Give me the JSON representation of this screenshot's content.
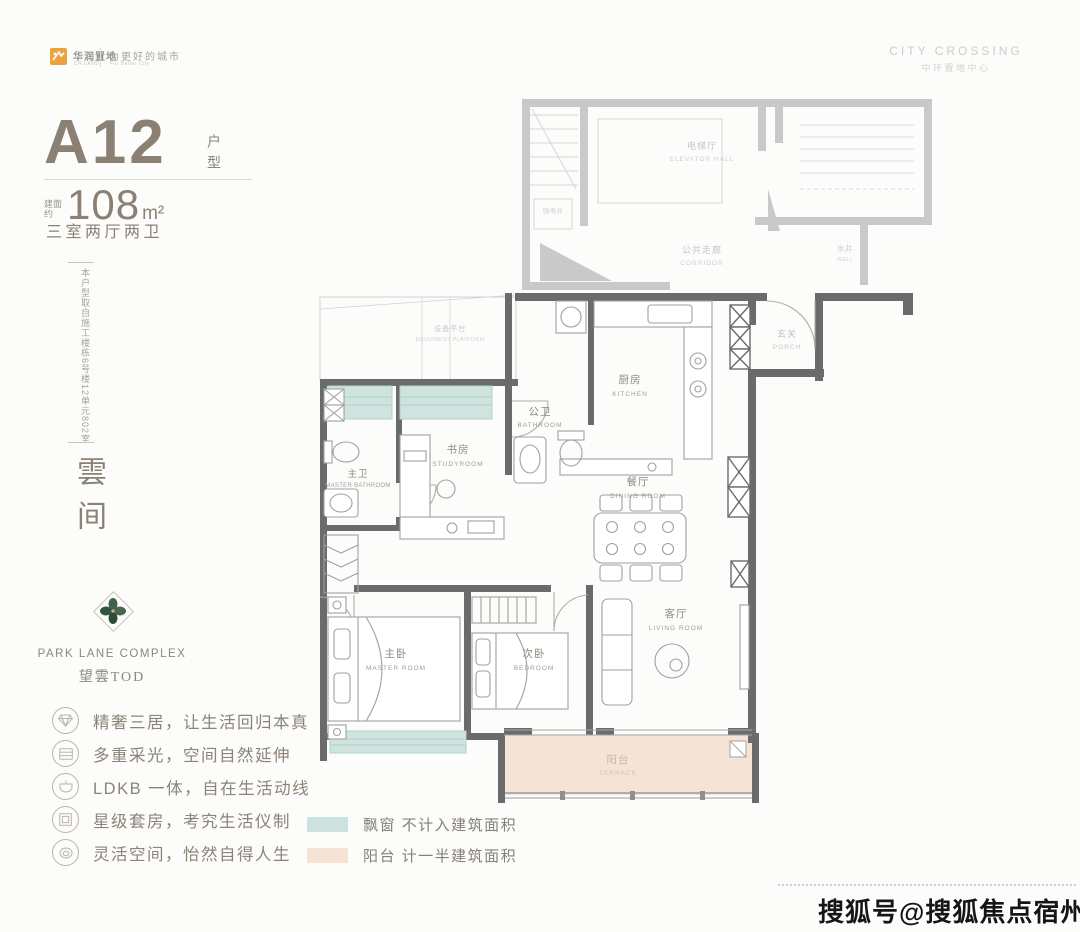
{
  "header": {
    "brand": {
      "name": "华润置地",
      "name_sub": "CR LAND",
      "tagline": "为更好的城市",
      "tagline_sub": "For Better City",
      "accent_color": "#eba33f"
    },
    "project": {
      "en": "CITY CROSSING",
      "cn": "中环置地中心"
    }
  },
  "unit": {
    "code": "A12",
    "code_label": "户型",
    "area_prefix": "建面约",
    "area_value": "108",
    "area_unit": "m²",
    "layout": "三室两厅两卫",
    "source_note": "本户型取自施工楼栋6号楼12单元802室",
    "series_name": "雲间"
  },
  "subbrand": {
    "en": "PARK LANE COMPLEX",
    "cn": "望雲TOD"
  },
  "features": [
    {
      "icon": "gem-icon",
      "text": "精奢三居，让生活回归本真"
    },
    {
      "icon": "daylight-icon",
      "text": "多重采光，空间自然延伸"
    },
    {
      "icon": "ldk-icon",
      "text": "LDKB 一体，自在生活动线"
    },
    {
      "icon": "suite-icon",
      "text": "星级套房，考究生活仪制"
    },
    {
      "icon": "flex-icon",
      "text": "灵活空间，怡然自得人生"
    }
  ],
  "legend": [
    {
      "color": "#cde2de",
      "label": "飘窗 不计入建筑面积"
    },
    {
      "color": "#f6e3d3",
      "label": "阳台 计一半建筑面积"
    }
  ],
  "floorplan": {
    "colors": {
      "wall": "#6b6b6b",
      "faint": "#c9c9c9",
      "bay_window": "#cfe3df",
      "balcony": "#f5e4d6"
    },
    "rooms": {
      "elevator_hall": {
        "cn": "电梯厅",
        "en": "ELEVATOR HALL"
      },
      "corridor": {
        "cn": "公共走廊",
        "en": "CORRIDOR"
      },
      "well": {
        "cn": "水井",
        "en": "WELL"
      },
      "shaft": {
        "cn": "强电井",
        "en": ""
      },
      "equipment": {
        "cn": "设备平台",
        "en": "EQUIPMENT PLATFORM"
      },
      "porch": {
        "cn": "玄关",
        "en": "PORCH"
      },
      "kitchen": {
        "cn": "厨房",
        "en": "KITCHEN"
      },
      "bathroom": {
        "cn": "公卫",
        "en": "BATHROOM"
      },
      "study": {
        "cn": "书房",
        "en": "STUDYROOM"
      },
      "master_bathroom": {
        "cn": "主卫",
        "en": "MASTER BATHROOM"
      },
      "dining": {
        "cn": "餐厅",
        "en": "DINING ROOM"
      },
      "living": {
        "cn": "客厅",
        "en": "LIVING ROOM"
      },
      "master_room": {
        "cn": "主卧",
        "en": "MASTER ROOM"
      },
      "bedroom": {
        "cn": "次卧",
        "en": "BEDROOM"
      },
      "terrace": {
        "cn": "阳台",
        "en": "TERRACE"
      }
    }
  },
  "watermark": "搜狐号@搜狐焦点宿州站"
}
